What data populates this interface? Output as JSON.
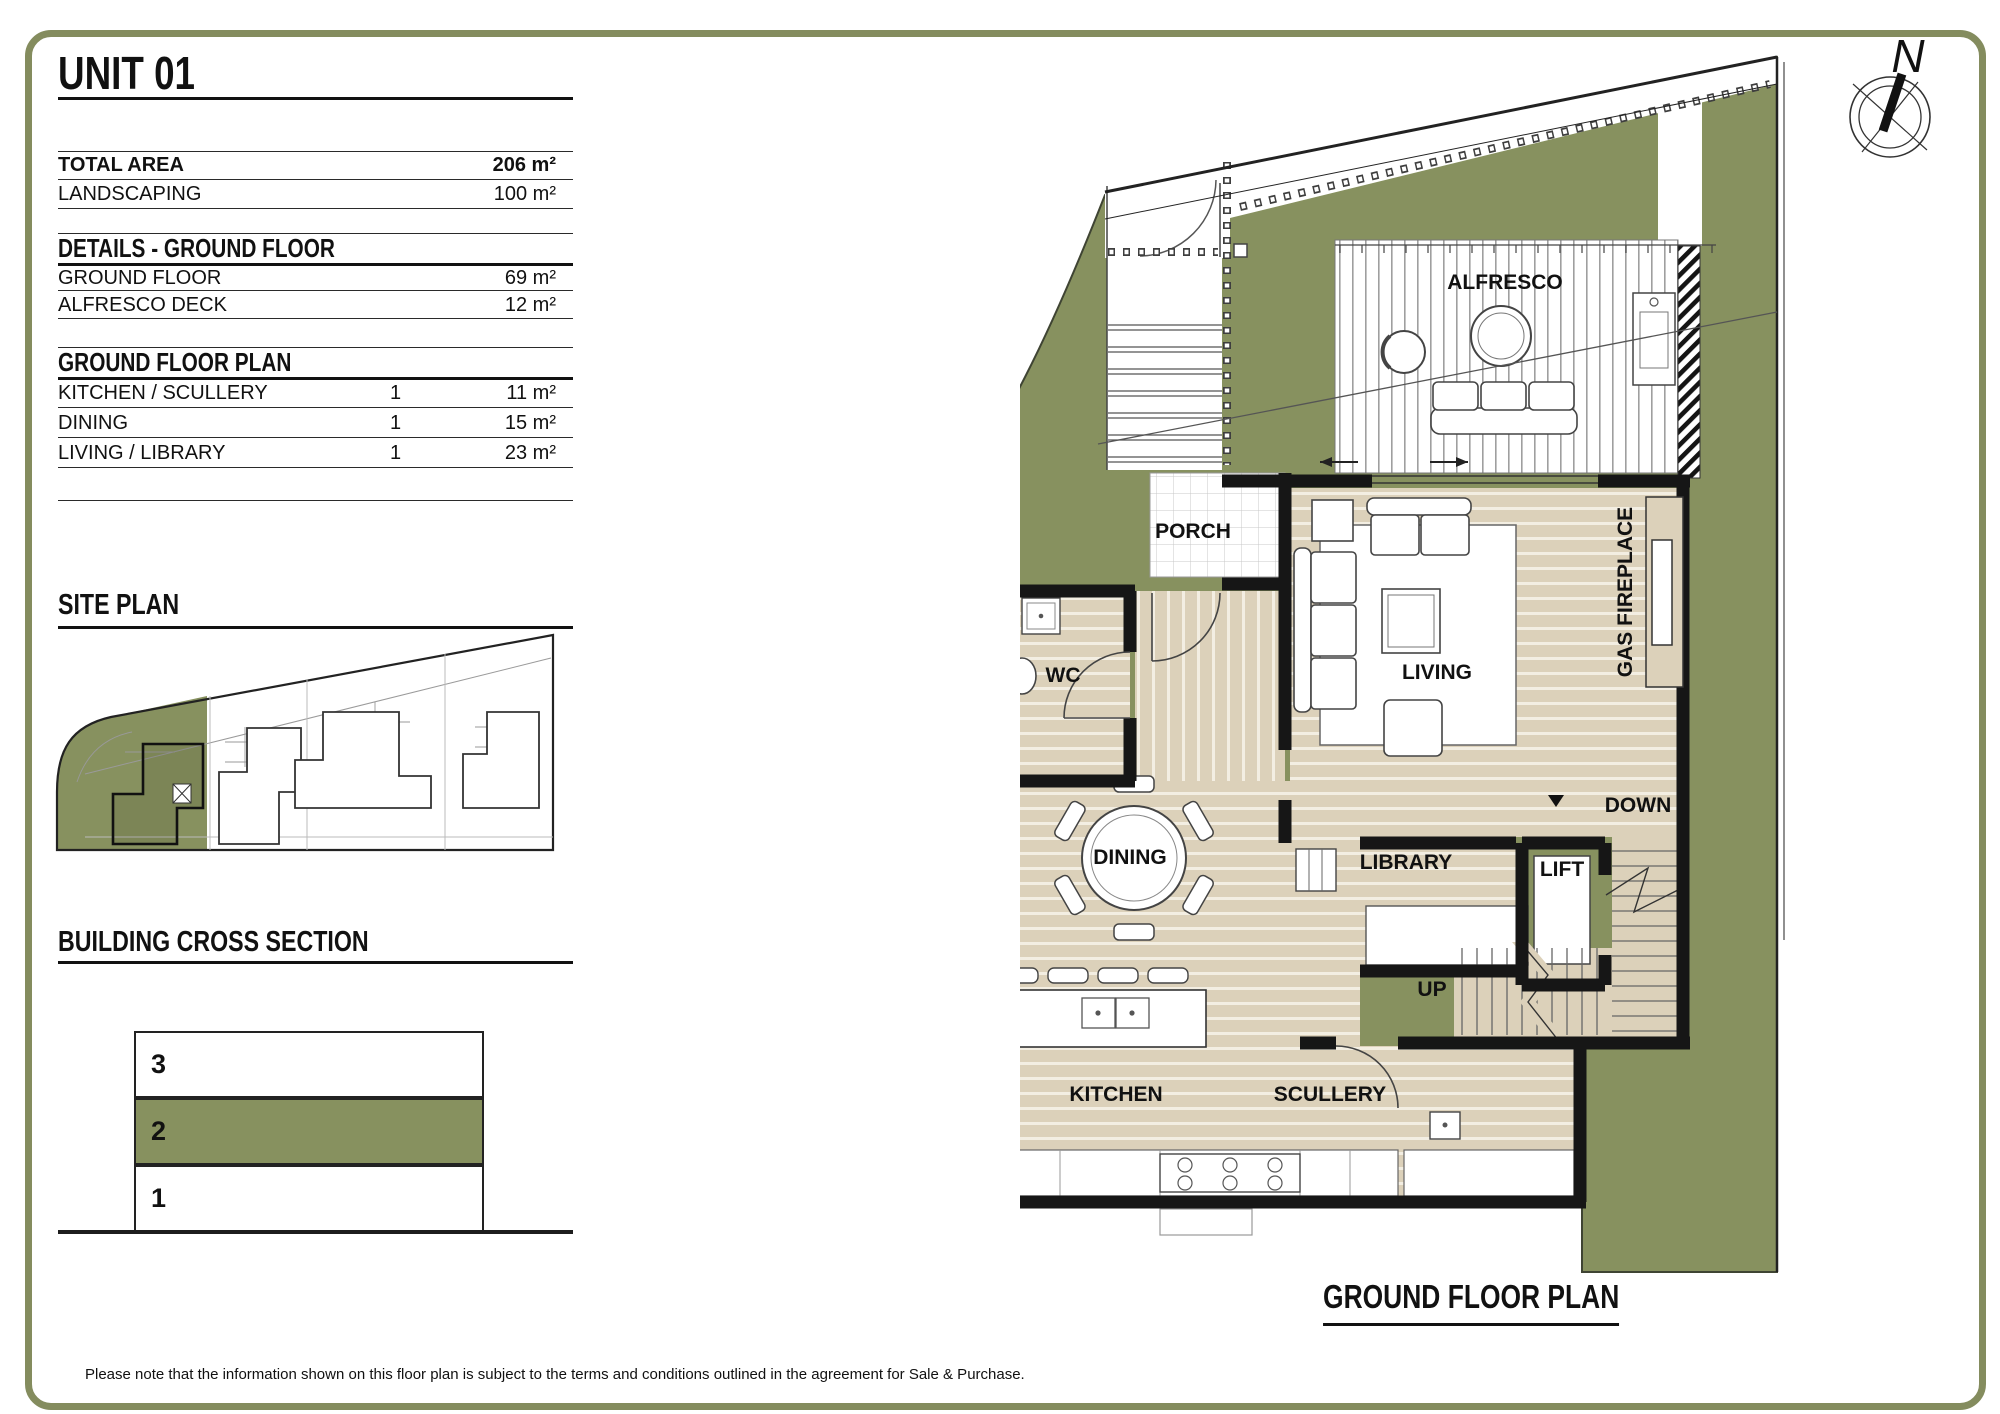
{
  "unit": {
    "title": "UNIT 01"
  },
  "summary": {
    "rows": [
      {
        "label": "TOTAL AREA",
        "value": "206 m²"
      },
      {
        "label": "LANDSCAPING",
        "value": "100 m²"
      }
    ]
  },
  "details": {
    "header": "DETAILS - GROUND FLOOR",
    "rows": [
      {
        "label": "GROUND FLOOR",
        "value": "69 m²"
      },
      {
        "label": "ALFRESCO DECK",
        "value": "12 m²"
      }
    ]
  },
  "schedule": {
    "header": "GROUND FLOOR PLAN",
    "rows": [
      {
        "label": "KITCHEN / SCULLERY",
        "qty": "1",
        "value": "11 m²"
      },
      {
        "label": "DINING",
        "qty": "1",
        "value": "15 m²"
      },
      {
        "label": "LIVING / LIBRARY",
        "qty": "1",
        "value": "23 m²"
      }
    ]
  },
  "site_plan": {
    "title": "SITE PLAN"
  },
  "cross_section": {
    "title": "BUILDING CROSS SECTION",
    "levels": [
      "3",
      "2",
      "1"
    ],
    "highlighted_level": "2"
  },
  "floor_plan": {
    "title": "GROUND FLOOR PLAN",
    "compass": "N",
    "rooms": {
      "alfresco": "ALFRESCO",
      "porch": "PORCH",
      "wc": "WC",
      "living": "LIVING",
      "gas_fireplace": "GAS FIREPLACE",
      "dining": "DINING",
      "library": "LIBRARY",
      "lift": "LIFT",
      "down": "DOWN",
      "up": "UP",
      "kitchen": "KITCHEN",
      "scullery": "SCULLERY"
    }
  },
  "footer": {
    "note": "Please note that the information shown on this floor plan is subject to the terms and conditions outlined in the agreement for Sale & Purchase."
  },
  "colors": {
    "olive": "#87915f",
    "floor_beige": "#dcd1ba",
    "wall": "#161616",
    "frame": "#848c5e"
  }
}
